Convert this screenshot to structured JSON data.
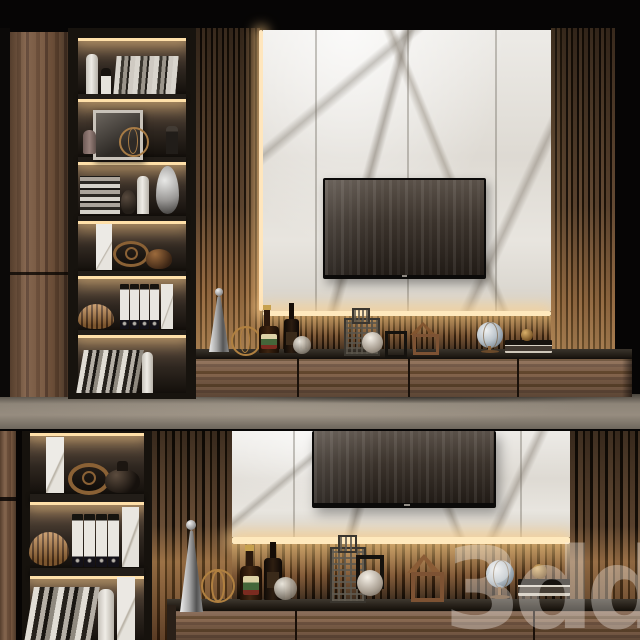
{
  "watermark": {
    "text": "3ddd"
  },
  "palette": {
    "background": "#060505",
    "walnut_wood": "#75543c",
    "slat_gap": "#1c120a",
    "marble_white": "#e9e6e1",
    "led_warm": "#ffdfa8",
    "shelf_frame": "#17130e",
    "floor_grey": "#8d8478",
    "tv_screen": "#3b332c",
    "bronze_accent": "#a06a33"
  },
  "scene": {
    "description": "3D render of a modern TV wall unit: walnut cabinet, backlit bookshelf, white marble TV panel framed by vertical wood slats, LED strip lighting and a long drawer console styled with decor objects.",
    "views": [
      {
        "id": "top",
        "label": "full view",
        "objects": [
          "wardrobe door",
          "backlit bookshelf",
          "white bottle vases",
          "standing books",
          "framed sketch",
          "gold wire sphere",
          "mauve vase",
          "stacked books",
          "silver teardrop vase",
          "marble bookends",
          "eye sculpture",
          "bronze vase",
          "ribbed bronze bowl",
          "white ring binders",
          "leaning books",
          "wood slat panels",
          "marble tv panel",
          "wall-mounted tv",
          "led strips",
          "drawer console",
          "silver cone candlestick",
          "whiskey bottles",
          "glass spheres",
          "lattice tower sculpture",
          "house figurine",
          "desk globe",
          "stacked books with gold ball",
          "floor"
        ]
      },
      {
        "id": "bottom",
        "label": "detail view",
        "objects": [
          "backlit bookshelf",
          "marble bookends",
          "eye sculpture",
          "black vase",
          "ribbed bronze bowl",
          "white ring binders",
          "leaning books",
          "white bottle vase",
          "wood slat panels",
          "silver cone candlestick",
          "gold wire sphere",
          "whiskey bottles",
          "glass sphere",
          "lattice tower sculpture",
          "house figurine",
          "desk globe",
          "stacked books with gold ball",
          "marble tv panel",
          "tv bottom corner",
          "led strip",
          "drawer console"
        ]
      }
    ]
  }
}
